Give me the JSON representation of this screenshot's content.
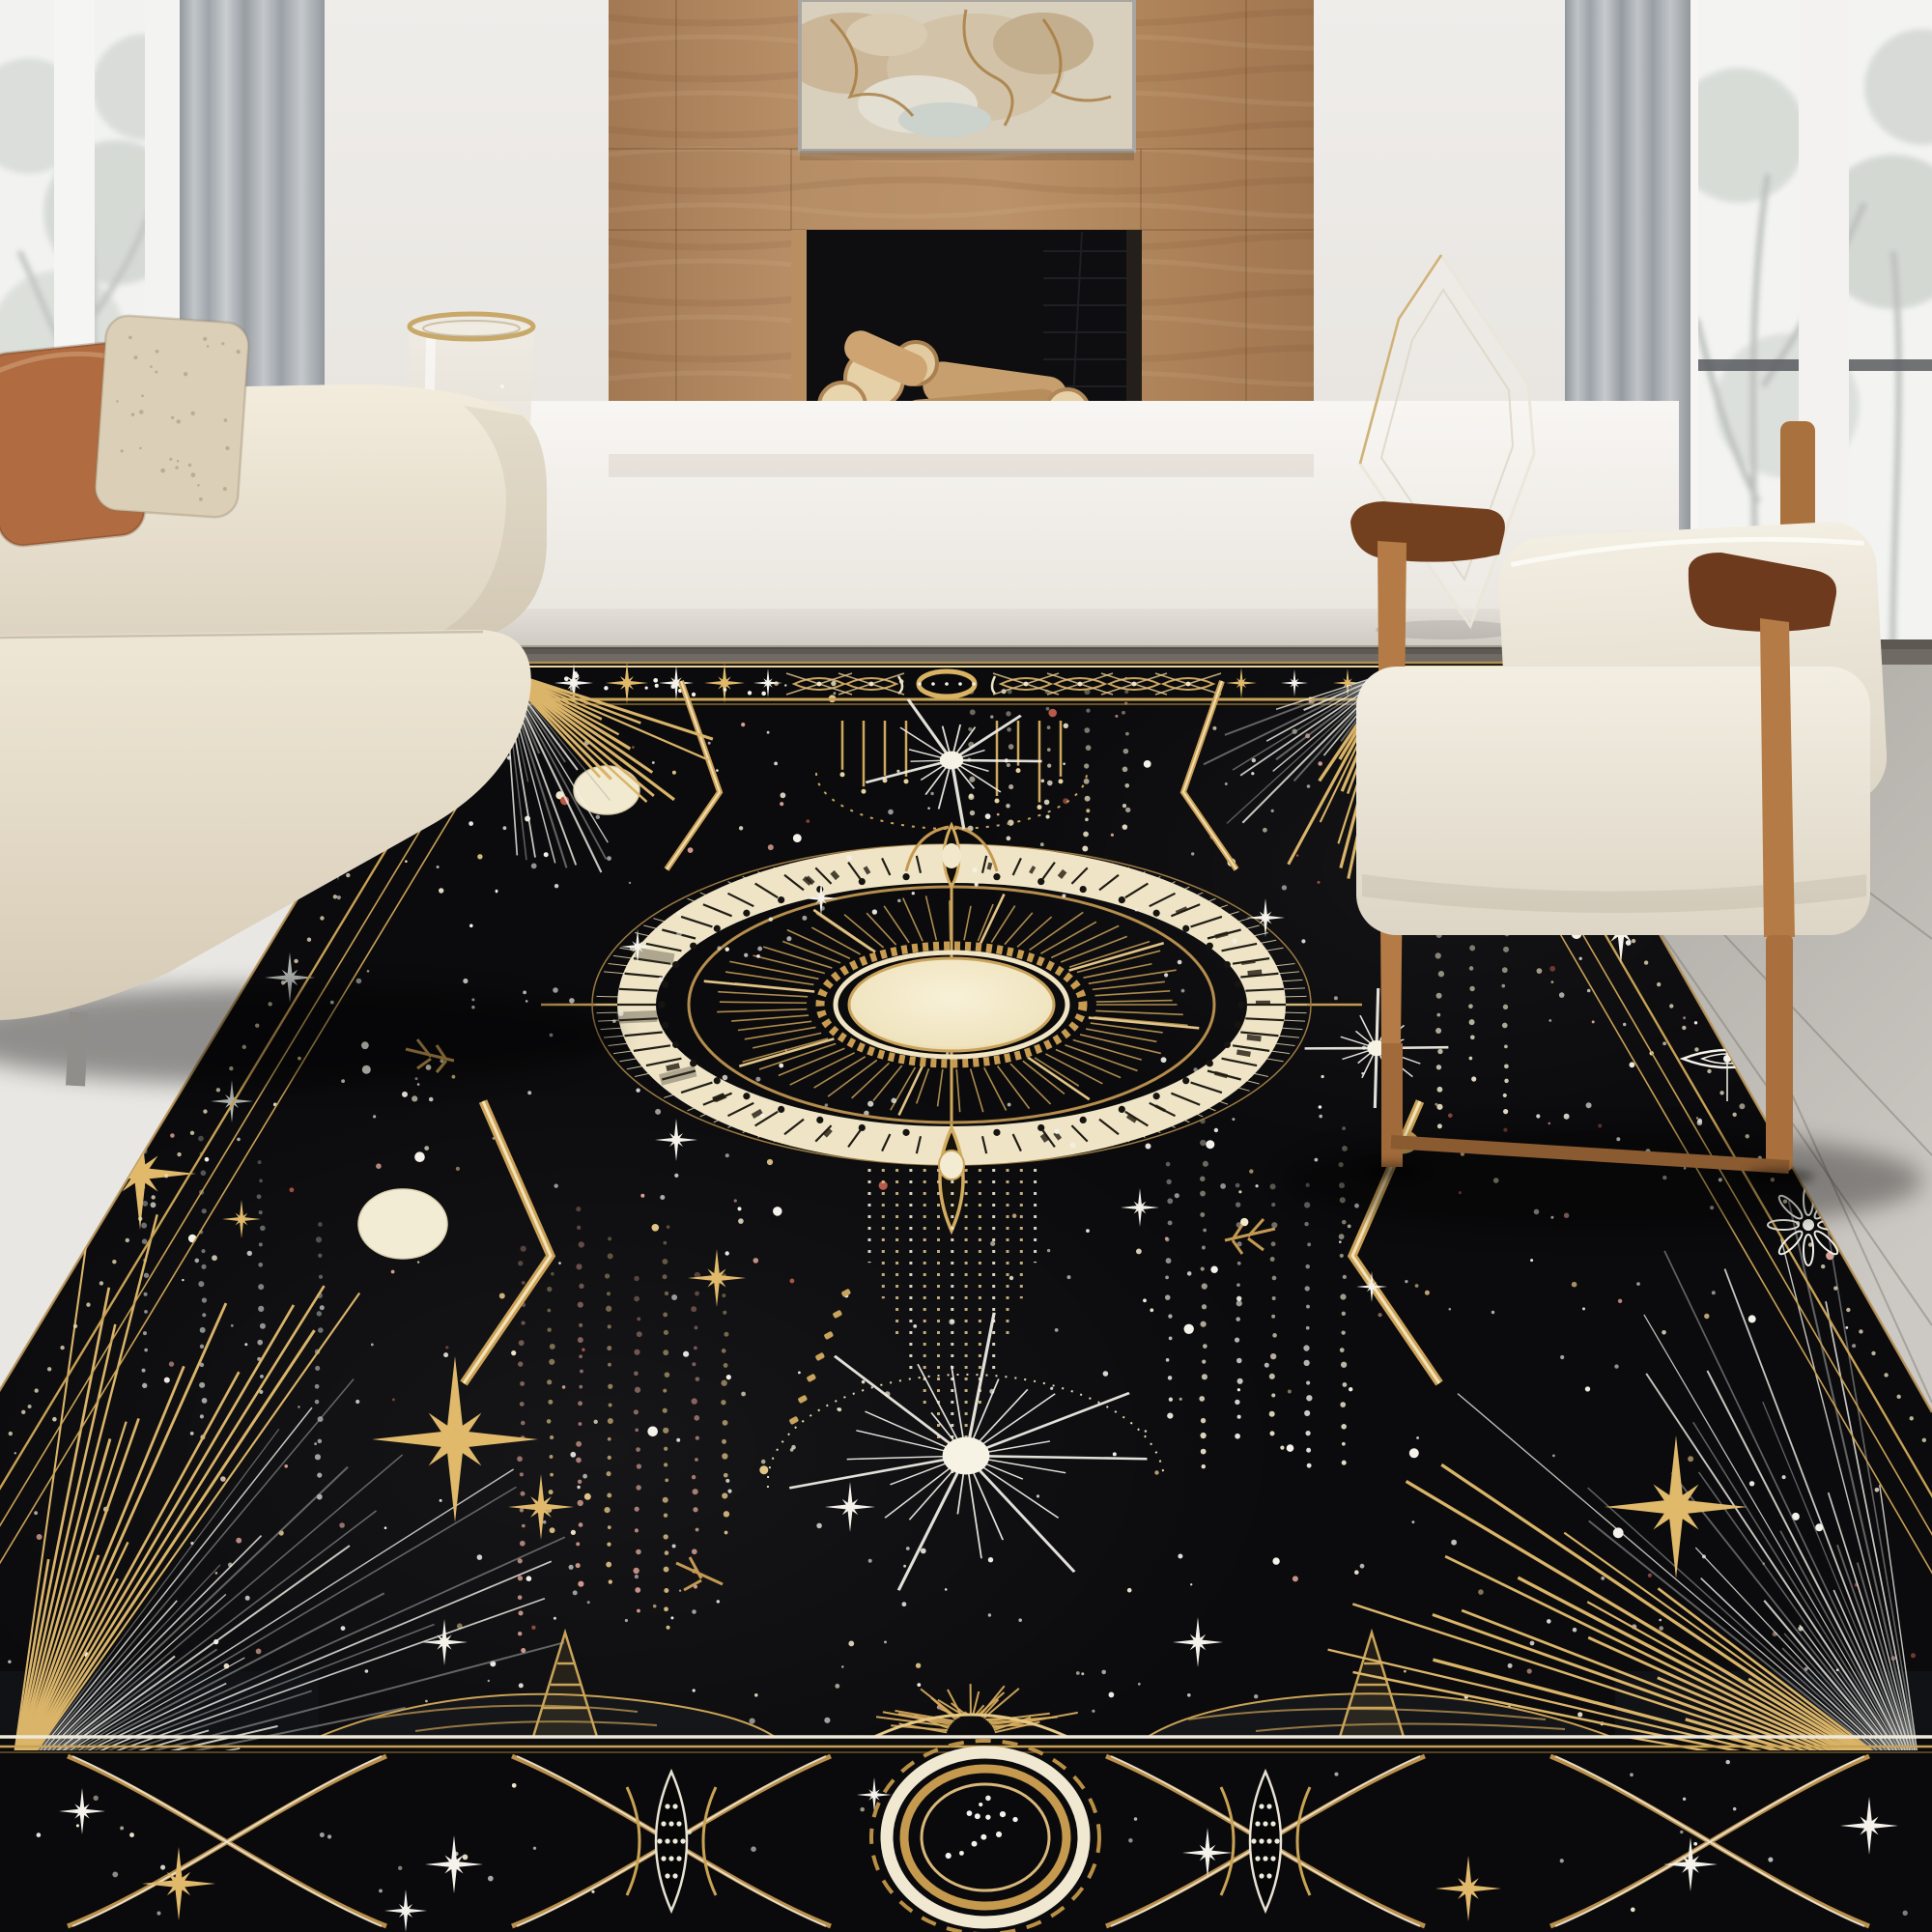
{
  "meta": {
    "domain": "Natural-Image",
    "description": "Lifestyle product photo: black-and-gold celestial tarot-style area rug in a modern living room with wood-panel fireplace, cream sofa and oak lounge chair",
    "visible_text": ""
  },
  "objects": {
    "rug": "celestial tarot area rug, black with gold and white astral motifs",
    "sofa": "cream fabric sofa",
    "pillow_left": "terracotta throw pillow",
    "pillow_right": "beige boucle throw pillow",
    "armchair": "oak-frame lounge chair with cream cushions",
    "fireplace": "light walnut panel fireplace with stacked firewood logs",
    "artwork": "abstract beige and gold wall art",
    "vase": "glass hurricane vase with gold rim",
    "sculpture": "clear glass diamond sculpture",
    "window_left": "left window with sheer and gray curtain",
    "window_right": "right window with gray curtain",
    "bench": "white floating hearth bench",
    "floor": "gray wood floor"
  },
  "rug_motifs": {
    "center_medallion": "sun dial medallion with cream glyph ring and radiating gold rays",
    "moons": 2,
    "gold_ring_orbit": 1,
    "starbursts": 3,
    "corner_fans": 4,
    "top_band": "sparkle stars, crossed eye motifs and ring medallion",
    "bottom_band": "large ring medallion flanked by crossed lens motifs and sparkle stars",
    "side_borders": "triple gold lines with dotted trails and star ornaments"
  },
  "palette": {
    "rug_black": "#0b0b0d",
    "gold": "#c9a254",
    "gold_light": "#e2c486",
    "cream": "#f2e9cd",
    "star_white": "#f4f2ea",
    "star_gray": "#b9bcb9",
    "pink_dot": "#d9a193",
    "ember_dot": "#b65a4a",
    "wood_panel": "#b28a63",
    "chair_wood": "#b57b46",
    "armrest_wood": "#73401f",
    "terracotta": "#b06b40",
    "boucle": "#dbcfb8",
    "sofa_cream": "#ece4d3",
    "wall": "#eae8e4",
    "curtain": "#aeb3b9",
    "bench_white": "#f6f4f0",
    "floor_strip": "#6f6a63",
    "floor_light": "#c0bcb7"
  },
  "starfield": {
    "seed": 11,
    "count": 540,
    "column_count": 26,
    "band_dots": 42
  }
}
